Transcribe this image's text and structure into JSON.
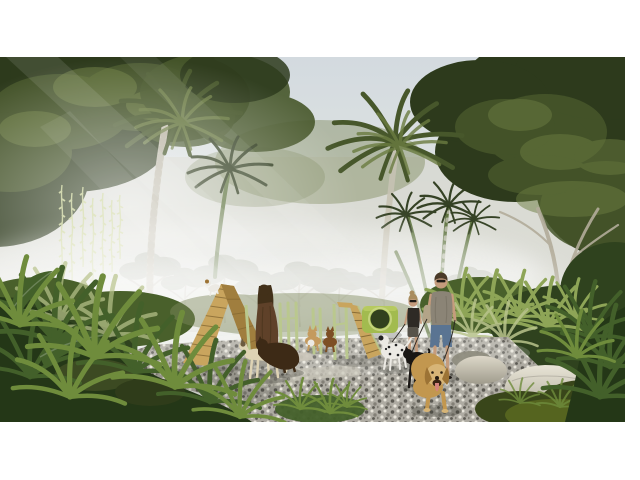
{
  "scene": {
    "subject": "Misty tropical dog park rendering: palm trees and ferns, wooden agility A-frame and ramp, green tunnel and posts, people walking dogs on a gravel path, smooth stone seats",
    "objects": [
      "sky",
      "fog",
      "palm-trees",
      "hanging-vines",
      "sun-rays",
      "gravel-path",
      "agility-a-frame",
      "agility-ramp",
      "agility-tunnel",
      "agility-posts",
      "robed-person",
      "woman-walker",
      "man-walker",
      "golden-retriever",
      "greyhound",
      "brown-dog",
      "dalmatian",
      "black-dog",
      "corgi",
      "terrier",
      "white-dog-on-a-frame",
      "stone-seats",
      "moss-mounds",
      "ferns"
    ]
  },
  "palette": {
    "sky_top": "#d3dadf",
    "sky_mid": "#e1e5e3",
    "sky_low": "#edefe8",
    "fog": "#d4d1c5",
    "ray": "#ffffff",
    "haze_green": "#7f8a5e",
    "canopy_dark": "#2d3a1c",
    "canopy_mid": "#47572b",
    "canopy_light": "#6b7c41",
    "leaf_bright": "#8ea557",
    "distant_tree": "#8f9682",
    "branch_pale": "#b2ac9a",
    "trunk_pale": "#c6c2b2",
    "trunk_green": "#5f7440",
    "vine": "#c5cf8b",
    "shrub_dark": "#2f421e",
    "shrub_mid": "#49602b",
    "fern_dark": "#243717",
    "fern_mid": "#43602a",
    "fern_light": "#6f8c3c",
    "fern_pale": "#b9c48c",
    "moss": "#55641f",
    "moss_dark": "#39461a",
    "gravel_base": "#aeaba2",
    "gravel_dark": "#5b5952",
    "gravel_mid": "#838077",
    "gravel_light": "#e7e4da",
    "slab": "#cbc7ba",
    "shadow": "#3c3c34",
    "wood_light": "#c9a55e",
    "wood_dark": "#a07e3e",
    "wood_line": "#6f5526",
    "equip_green": "#bac88e",
    "tunnel_green": "#a2bb4f",
    "tunnel_rim": "#cdd98a",
    "tunnel_hole": "#32411e",
    "tunnel_top": "#c3d46a",
    "stone_light": "#ddd8c9",
    "stone_shade": "#a09c8d",
    "stone_light2": "#e8e4d6",
    "stone_shade2": "#b5b1a1",
    "stone_grey": "#8f8d80",
    "skin": "#c59c7d",
    "hair_man": "#4a3a28",
    "hair_woman": "#a98c5e",
    "sunglasses": "#1e1a16",
    "tank": "#8b8476",
    "bag": "#b3a488",
    "denim": "#5a7492",
    "top_dark": "#2e2a25",
    "bottoms_w": "#57534a",
    "robe": "#5f4129",
    "robe_dark": "#423019",
    "dog_golden": "#c2974f",
    "dog_golden_light": "#d7b577",
    "dog_ear": "#9c7335",
    "dog_cream": "#ded3b4",
    "dog_patch": "#6b5a3f",
    "dog_brown": "#3d2a16",
    "dog_black": "#191613",
    "dog_white": "#eceae4",
    "corgi_tan": "#c49a5e",
    "terrier_brown": "#7d4f24",
    "tongue": "#d4837d",
    "leash": "#2a2620"
  }
}
